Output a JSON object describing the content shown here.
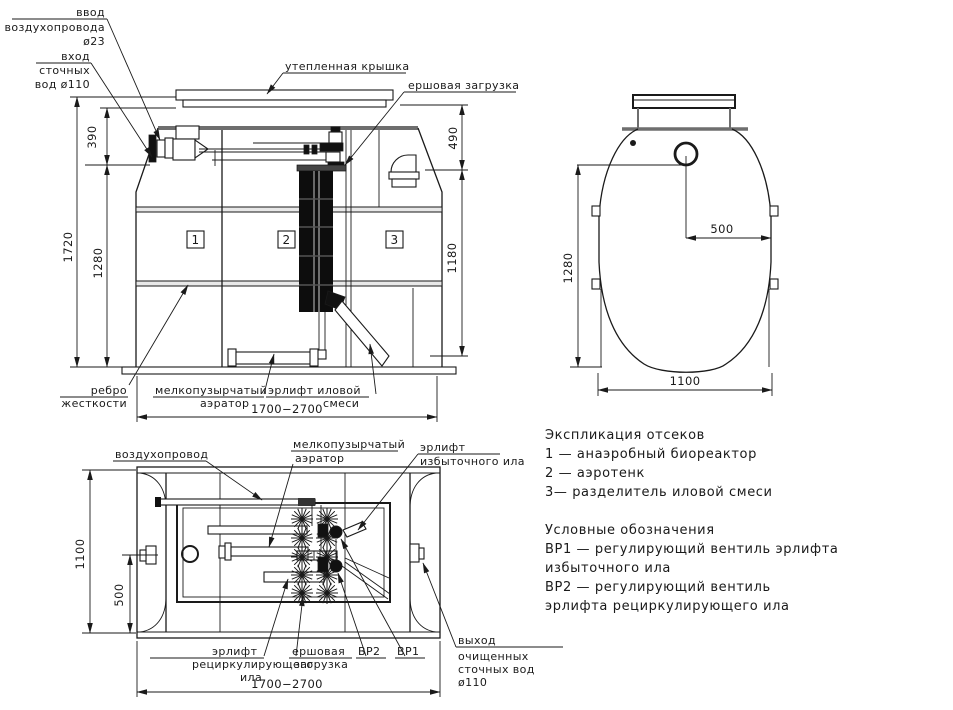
{
  "front_view": {
    "labels": {
      "air_inlet_1": "ввод",
      "air_inlet_2": "воздухопровода",
      "air_inlet_3": "ø23",
      "sewage_inlet_1": "вход",
      "sewage_inlet_2": "сточных",
      "sewage_inlet_3": "вод ø110",
      "insulated_cover": "утепленная крышка",
      "brush_load": "ершовая загрузка",
      "stiffening_rib_1": "ребро",
      "stiffening_rib_2": "жесткости",
      "fine_bubble_aerator_1": "мелкопузырчатый",
      "fine_bubble_aerator_2": "аэратор",
      "sludge_airlift_1": "эрлифт иловой",
      "sludge_airlift_2": "смеси"
    },
    "compartments": {
      "c1": "1",
      "c2": "2",
      "c3": "3"
    },
    "dims": {
      "total_height": "1720",
      "top": "390",
      "body": "1280",
      "right_top": "490",
      "right_body": "1180",
      "length": "1700−2700"
    }
  },
  "side_view": {
    "dims": {
      "height": "1280",
      "offset": "500",
      "width": "1100"
    }
  },
  "plan_view": {
    "labels": {
      "air_duct": "воздухопровод",
      "fine_bubble_aerator_1": "мелкопузырчатый",
      "fine_bubble_aerator_2": "аэратор",
      "excess_airlift_1": "эрлифт",
      "excess_airlift_2": "избыточного ила",
      "recirc_airlift_1": "эрлифт",
      "recirc_airlift_2": "рециркулирующего",
      "recirc_airlift_3": "ила",
      "brush_load_1": "ершовая",
      "brush_load_2": "загрузка",
      "valve_vr2": "ВР2",
      "valve_vr1": "ВР1",
      "outlet_1": "выход",
      "outlet_2": "очищенных",
      "outlet_3": "сточных вод",
      "outlet_4": "ø110"
    },
    "dims": {
      "width": "1100",
      "port_offset": "500",
      "length": "1700−2700"
    }
  },
  "legend": {
    "title_compartments": "Экспликация отсеков",
    "compartment_1": "1 —  анаэробный биореактор",
    "compartment_2": "2 —  аэротенк",
    "compartment_3": "3—  разделитель иловой смеси",
    "title_symbols": "Условные обозначения",
    "vr1_line1": "ВР1 —  регулирующий вентиль эрлифта",
    "vr1_line2": "избыточного ила",
    "vr2_line1": "ВР2 —  регулирующий вентиль",
    "vr2_line2": "эрлифта рециркулирующего ила"
  },
  "colors": {
    "line": "#1a1a1a",
    "rim_gray": "#6e6e6e",
    "fill_dark": "#111111"
  }
}
